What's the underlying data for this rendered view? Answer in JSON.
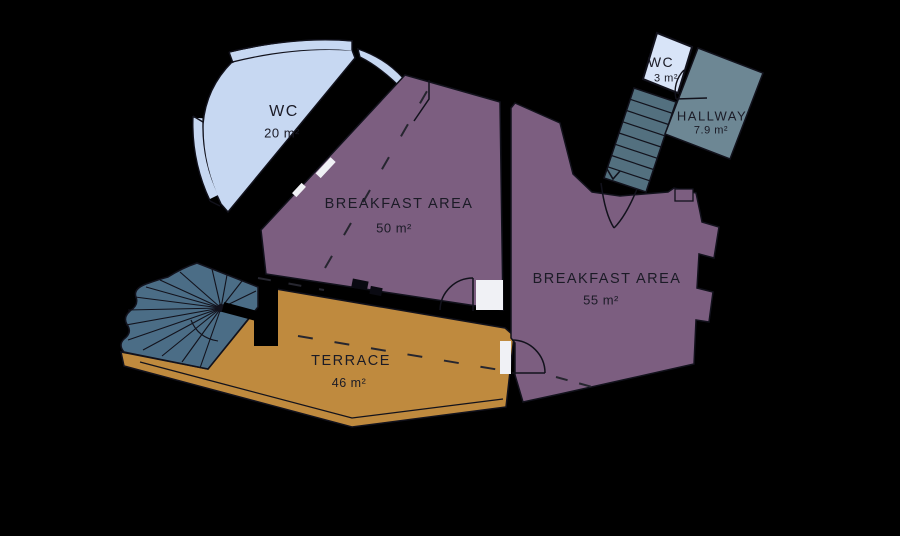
{
  "plan": {
    "background": "#000000",
    "outline_color": "#12121c",
    "rooms": [
      {
        "id": "wc-large",
        "name": "WC",
        "area": "20 m²",
        "color": "#c7d8f2"
      },
      {
        "id": "breakfast-area-1",
        "name": "BREAKFAST AREA",
        "area": "50 m²",
        "color": "#7c5e80"
      },
      {
        "id": "breakfast-area-2",
        "name": "BREAKFAST AREA",
        "area": "55 m²",
        "color": "#7c5e80"
      },
      {
        "id": "wc-small",
        "name": "WC",
        "area": "3 m²",
        "color": "#d8e4f8"
      },
      {
        "id": "hallway",
        "name": "HALLWAY",
        "area": "7.9 m²",
        "color": "#6d8794"
      },
      {
        "id": "terrace",
        "name": "TERRACE",
        "area": "46 m²",
        "color": "#bf8a3e"
      }
    ],
    "stairs": {
      "straight_color": "#53707f",
      "spiral_color": "#4b6d86"
    }
  }
}
